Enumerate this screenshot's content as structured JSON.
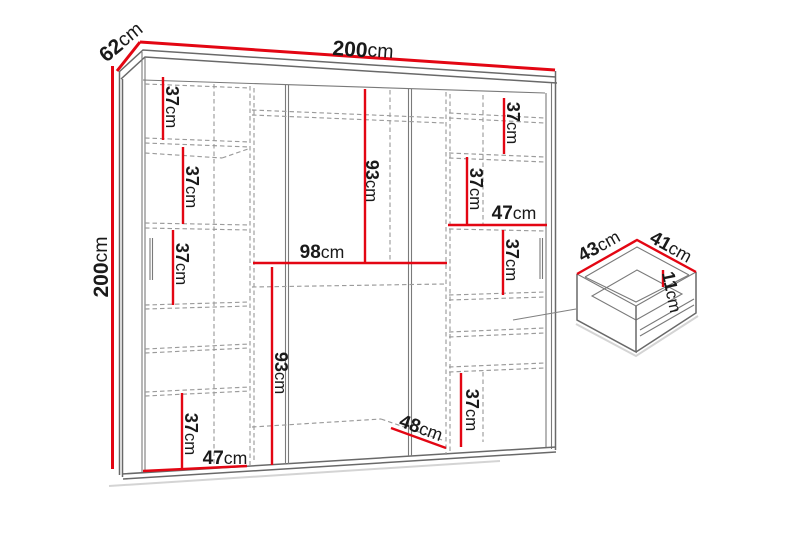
{
  "diagram": {
    "wardrobe": {
      "width": {
        "value": "200",
        "unit": "cm"
      },
      "depth": {
        "value": "62",
        "unit": "cm"
      },
      "height": {
        "value": "200",
        "unit": "cm"
      },
      "left_column": {
        "shelf_spacing_1": {
          "value": "37",
          "unit": "cm"
        },
        "shelf_spacing_2": {
          "value": "37",
          "unit": "cm"
        },
        "shelf_spacing_3": {
          "value": "37",
          "unit": "cm"
        },
        "shelf_spacing_4": {
          "value": "37",
          "unit": "cm"
        },
        "inner_width": {
          "value": "47",
          "unit": "cm"
        }
      },
      "center_section": {
        "upper_height": {
          "value": "93",
          "unit": "cm"
        },
        "inner_width": {
          "value": "98",
          "unit": "cm"
        },
        "lower_height": {
          "value": "93",
          "unit": "cm"
        },
        "bottom_width": {
          "value": "48",
          "unit": "cm"
        }
      },
      "right_column": {
        "shelf_spacing_1": {
          "value": "37",
          "unit": "cm"
        },
        "shelf_spacing_2": {
          "value": "37",
          "unit": "cm"
        },
        "inner_width": {
          "value": "47",
          "unit": "cm"
        },
        "shelf_spacing_3": {
          "value": "37",
          "unit": "cm"
        },
        "shelf_spacing_4": {
          "value": "37",
          "unit": "cm"
        }
      }
    },
    "drawer": {
      "width": {
        "value": "43",
        "unit": "cm"
      },
      "depth": {
        "value": "41",
        "unit": "cm"
      },
      "height": {
        "value": "11",
        "unit": "cm"
      }
    },
    "colors": {
      "dimension_red": "#e30613",
      "outline_gray": "#696969",
      "dashed_gray": "#9b9b9b",
      "label_text": "#1a1a1a",
      "background": "#ffffff"
    }
  }
}
